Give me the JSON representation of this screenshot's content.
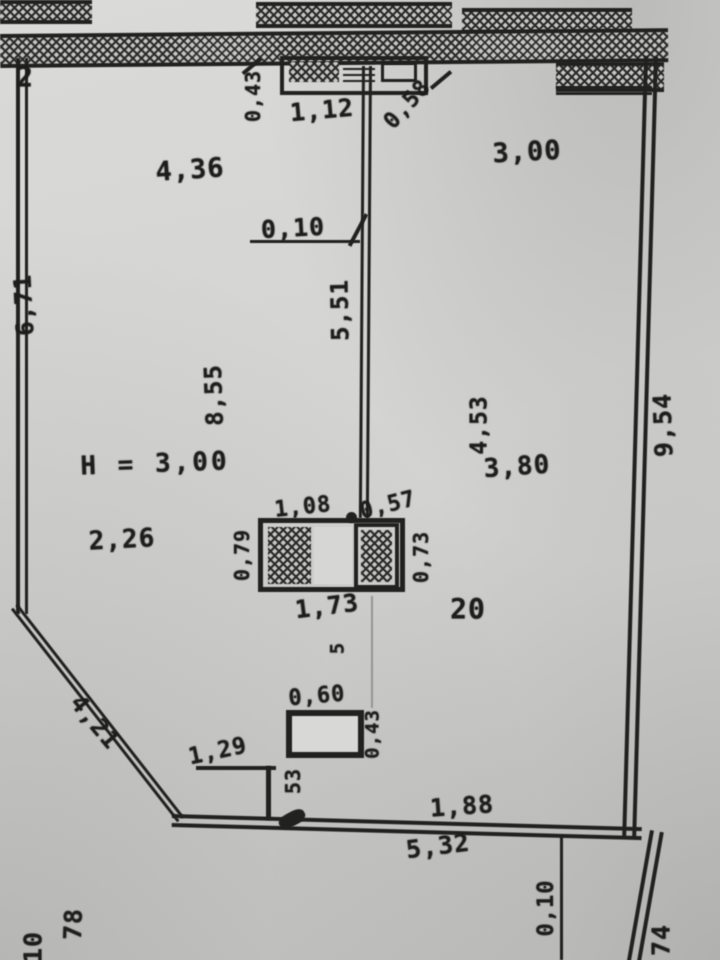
{
  "drawing": {
    "apartment_number": "20",
    "ceiling_height_note": "H = 3,00",
    "dims": {
      "corner_top_left": "2",
      "door_left_side": "0,43",
      "door_width": "1,12",
      "door_right_side": "0,58",
      "room_top_left_width": "4,36",
      "room_top_right_width": "3,00",
      "partition_offset": "0,10",
      "partition_length": "5,51",
      "left_wall_length": "6,71",
      "room_depth_left": "8,55",
      "right_room_depth": "4,53",
      "right_room_width": "3,80",
      "left_mid_width": "2,26",
      "unit_top_left": "1,08",
      "unit_top_right": "0,57",
      "unit_left_depth": "0,79",
      "unit_right_depth": "0,73",
      "unit_bottom_width": "1,73",
      "below_unit": "5",
      "shaft_width": "0,60",
      "shaft_depth": "0,43",
      "diagonal_wall": "4,21",
      "step_width": "1,29",
      "step_side": "53",
      "bottom_wall_upper": "1,88",
      "bottom_wall_lower": "5,32",
      "bottom_right_offset": "0,10",
      "right_wall_length": "9,54",
      "bottom_right_partial": "74",
      "bottom_left_partial": "78",
      "bottom_left_corner": "10"
    }
  }
}
